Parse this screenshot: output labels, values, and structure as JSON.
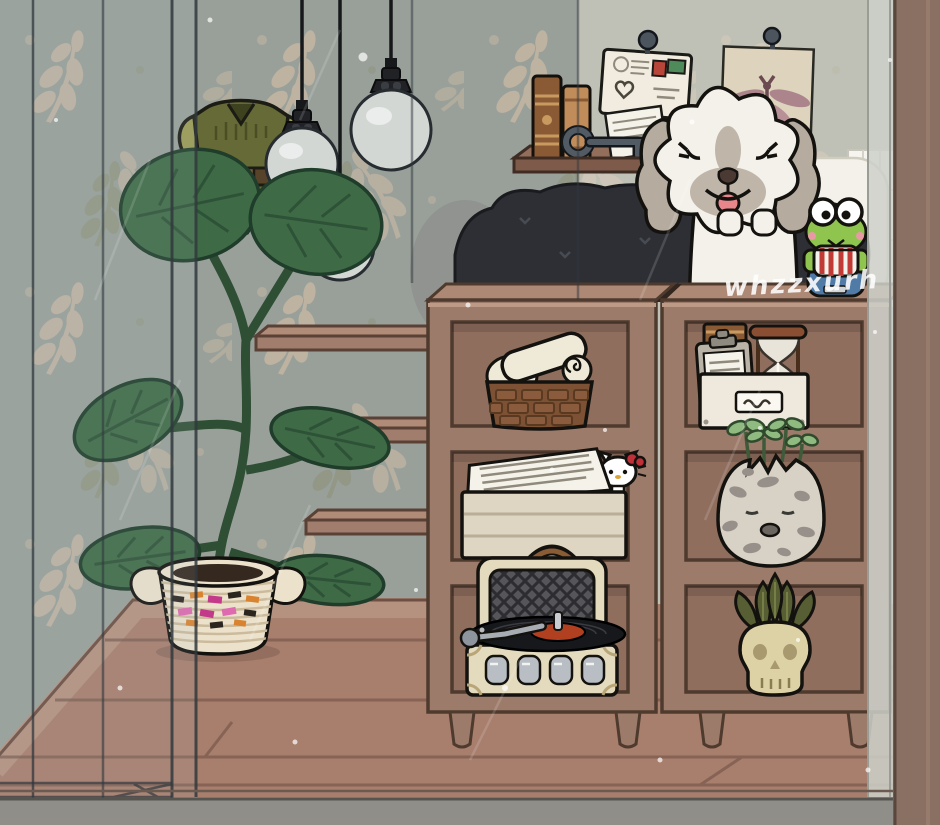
{
  "scene": {
    "title": "toca-style-cozy-bedroom",
    "watermark": "whzzxurh",
    "objects": [
      {
        "id": "wallpaper",
        "label": "leaf pattern wallpaper"
      },
      {
        "id": "glass-wall",
        "label": "glass room divider walls"
      },
      {
        "id": "pendant-bulb-1",
        "label": "hanging glass pendant bulb"
      },
      {
        "id": "pendant-bulb-2",
        "label": "hanging glass pendant bulb"
      },
      {
        "id": "pendant-bulb-3",
        "label": "hanging glass pendant bulb"
      },
      {
        "id": "hanging-costume",
        "label": "green elf tunic costume hanging"
      },
      {
        "id": "stair-shelves",
        "label": "three floating wall step shelves"
      },
      {
        "id": "wall-shelf",
        "label": "wooden wall shelf"
      },
      {
        "id": "books",
        "label": "two brown books"
      },
      {
        "id": "vintage-key",
        "label": "old skeleton key"
      },
      {
        "id": "letter",
        "label": "handwritten letter on stand"
      },
      {
        "id": "postcard",
        "label": "pinned postcard with heart and stamps"
      },
      {
        "id": "dragonfly-art",
        "label": "pinned dragonfly artwork"
      },
      {
        "id": "beanbag",
        "label": "dark charcoal bean bag bed"
      },
      {
        "id": "pillow",
        "label": "white pillow headboard"
      },
      {
        "id": "dog",
        "label": "fluffy white dog with gray ears"
      },
      {
        "id": "keroppi",
        "label": "keroppi frog figurine on denim pouf"
      },
      {
        "id": "shelf-unit-left",
        "label": "wooden cube shelf unit"
      },
      {
        "id": "shelf-unit-right",
        "label": "wooden cube shelf unit"
      },
      {
        "id": "towel-basket",
        "label": "woven basket with rolled towels"
      },
      {
        "id": "paper-tray",
        "label": "paper tray with documents and hello kitty"
      },
      {
        "id": "record-player",
        "label": "vintage suitcase record player with vinyl"
      },
      {
        "id": "organizer-box",
        "label": "storage box with book clipboard hourglass"
      },
      {
        "id": "egg-planter",
        "label": "cracked egg planter with sprouts and sleepy face"
      },
      {
        "id": "skull-succulent",
        "label": "succulent in skull pot"
      },
      {
        "id": "potted-plant",
        "label": "fiddle leaf fig in patterned woven basket"
      },
      {
        "id": "floor",
        "label": "brown plank wood floor"
      }
    ]
  },
  "colors": {
    "wallpaper": "#99a09a",
    "wallpaper_leaf": "#c7b7a2",
    "wallpaper_leaf_olive": "#8b9175",
    "wall_light_overlay": "#e6dfd2",
    "floor": "#a87e6d",
    "baseboard": "#b5927f",
    "floor_line": "#7b5b4e",
    "glass_rail": "#8f8e88",
    "right_wall": "#8a6f63",
    "glass_line": "#31383d",
    "stair_shelf": "#a07d6c",
    "wall_shelf": "#7d5a49",
    "shelf_unit": "#9d7b6a",
    "shelf_unit_top": "#ad8975",
    "shelf_unit_back": "#8f6e5e",
    "shelf_unit_outline": "#4f3a2e",
    "beanbag": "#2d2f35",
    "pillow": "#f3f1ea",
    "dog_fur": "#f4f1ea",
    "dog_gray": "#b5ab9e",
    "tongue": "#e9868c",
    "costume": "#666a36",
    "costume_sleeve": "#9b9b52",
    "bulb_glass": "#d3d7d4",
    "plant_green": "#3e6b46",
    "basket_cream": "#ece2cc",
    "towel": "#efe9d8",
    "basket_brown": "#7c5134",
    "record_case": "#e4dabd",
    "grille": "#55555a",
    "vinyl": "#17181c",
    "vinyl_label": "#b0401f",
    "organizer": "#efe9dd",
    "book_brown": "#8a5a35",
    "book_tan": "#c08c5a",
    "hourglass_wood": "#8a4f33",
    "egg": "#d8d1c5",
    "egg_spot": "#97908a",
    "sprout": "#8fba80",
    "skull": "#ddd2a6",
    "succulent": "#575e33",
    "keroppi": "#8fc44f",
    "keroppi_red": "#c23a35",
    "keroppi_blue": "#4f7ba6",
    "kitty_bow": "#c03038",
    "paper": "#f5f2ea",
    "art_paper": "#ded3bc",
    "dragonfly": "#a88089",
    "watermark": "#ffffff"
  }
}
